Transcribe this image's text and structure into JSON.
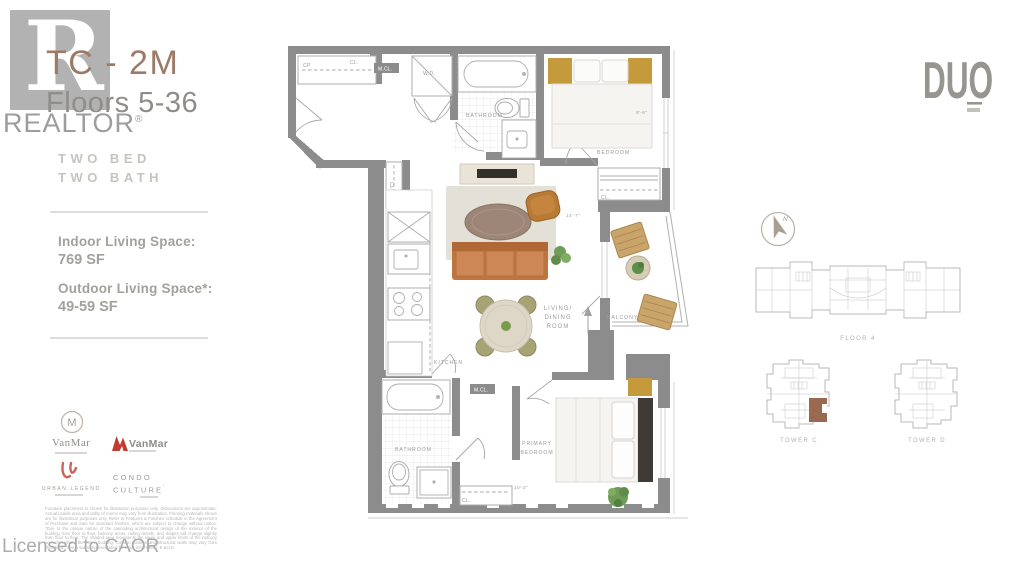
{
  "watermark": {
    "r_glyph": "R",
    "word": "REALTOR",
    "reg": "®",
    "licensed": "Licensed to CAOR"
  },
  "sidebar": {
    "unit_code": "TC - 2M",
    "floors": "Floors 5-36",
    "spec_lines": [
      "TWO BED",
      "TWO BATH"
    ],
    "indoor_label": "Indoor Living Space:",
    "indoor_value": "769 SF",
    "outdoor_label": "Outdoor Living Space*:",
    "outdoor_value": "49-59 SF",
    "logos": {
      "vanmar_monogram": "M",
      "vanmar_name": "VanMar",
      "vanmar2_name": "VanMar",
      "urban_legend_name": "URBAN LEGEND",
      "condo_line1": "CONDO",
      "condo_line2": "CULTURE",
      "condo_reg": "'"
    },
    "disclaimer": "Furniture placement is shown for illustration purposes only. Dimensions are approximate. Actual usable area and utility of rooms may vary from illustration. Flooring materials shown are for illustration purposes only. Refer to Features & Finishes schedule in the Agreement of Purchase and Sale for standard finishes, which are subject to change without notice. *Due to the unique nature of the cascading architectural design of the exterior of the building from floor to floor, balcony areas, railing details, and drapes will change slightly from floor to floor. The shaded area represents the lower and upper limits of the balcony area throughout the entire building. Column position and structural walls may vary from illustration. See a sales representative for more information. E.&O.E."
  },
  "floorplan": {
    "rooms": {
      "bathroom": "BATHROOM",
      "bedroom": "BEDROOM",
      "kitchen": "KITCHEN",
      "living_lines": [
        "LIVING/",
        "DINING",
        "ROOM"
      ],
      "balcony": "BALCONY",
      "primary_lines": [
        "PRIMARY",
        "BEDROOM"
      ]
    },
    "closets": {
      "cl": "CL.",
      "mcl": "M.CL.",
      "wd": "W.D.",
      "cp": "CP"
    },
    "dims": {
      "bedroom_depth": "8'-6\"",
      "living_width": "14'-7\"",
      "primary_width": "10'-2\""
    },
    "north": "N"
  },
  "branding": {
    "building_logo": "DUO"
  },
  "keyplans": {
    "floor_label": "FLOOR 4",
    "tower_c_label": "TOWER C",
    "tower_d_label": "TOWER D"
  },
  "colors": {
    "wall": "#8c8c8c",
    "accent_title": "#9d7a66",
    "sofa": "#c97f4e",
    "gold": "#c49a3c",
    "balcony_wood": "#c9a56b",
    "rug": "#e3e0d8",
    "plant": "#6f9d57",
    "headboard": "#3f3a36",
    "keyplan_highlight": "#9a6a50",
    "vanmar_red": "#c23b2e",
    "urban_red": "#cf6258"
  }
}
